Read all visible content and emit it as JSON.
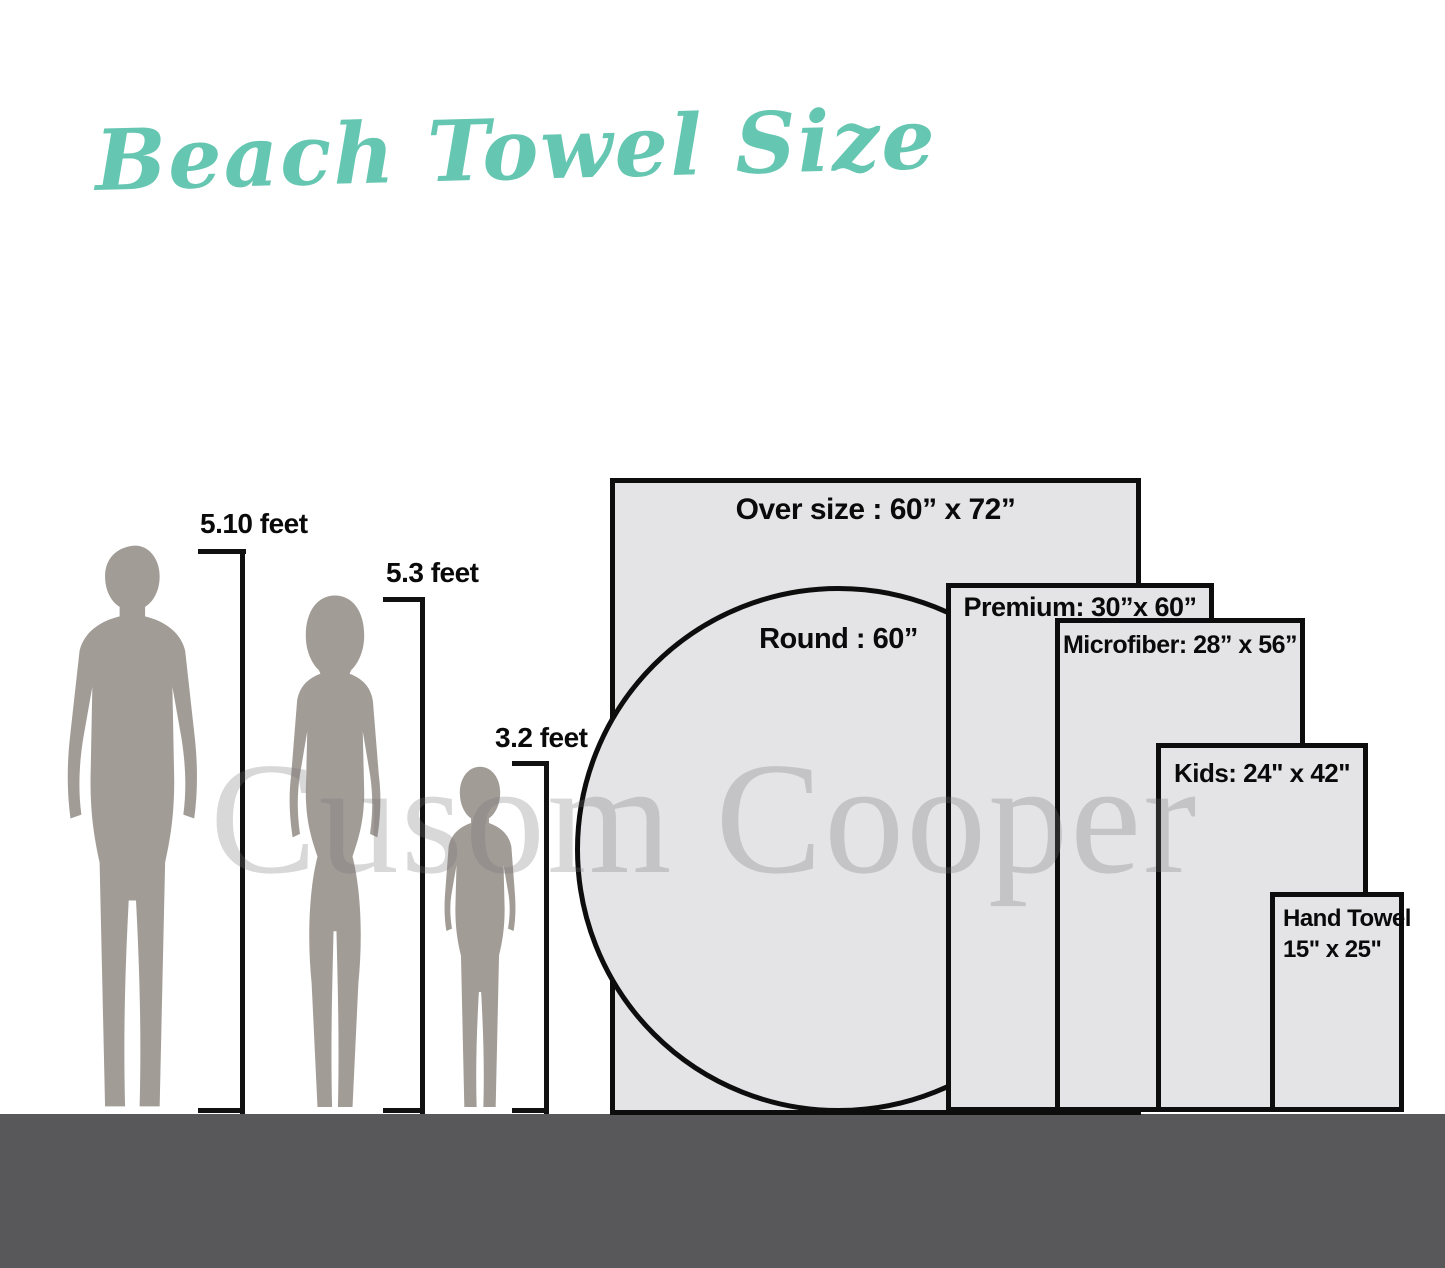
{
  "title": "Beach Towel Size",
  "watermark": "Cusom Cooper",
  "colors": {
    "accent": "#65c6b1",
    "silhouette": "#a29c97",
    "towel_fill": "#e4e4e6",
    "towel_border": "#0d0d0d",
    "ground": "#58585a",
    "label_text": "#0a0a0a",
    "watermark": "rgba(115,115,120,0.28)"
  },
  "figures": [
    {
      "name": "man",
      "height_label": "5.10 feet"
    },
    {
      "name": "woman",
      "height_label": "5.3 feet"
    },
    {
      "name": "child",
      "height_label": "3.2 feet"
    }
  ],
  "towels": [
    {
      "name": "oversize",
      "label": "Over size : 60” x 72”"
    },
    {
      "name": "round",
      "label": "Round : 60”"
    },
    {
      "name": "premium",
      "label": "Premium:  30”x 60”"
    },
    {
      "name": "microfiber",
      "label": "Microfiber: 28” x 56”"
    },
    {
      "name": "kids",
      "label": "Kids: 24\" x 42\""
    },
    {
      "name": "hand",
      "label": "Hand Towel",
      "label2": "15\" x 25\""
    }
  ]
}
